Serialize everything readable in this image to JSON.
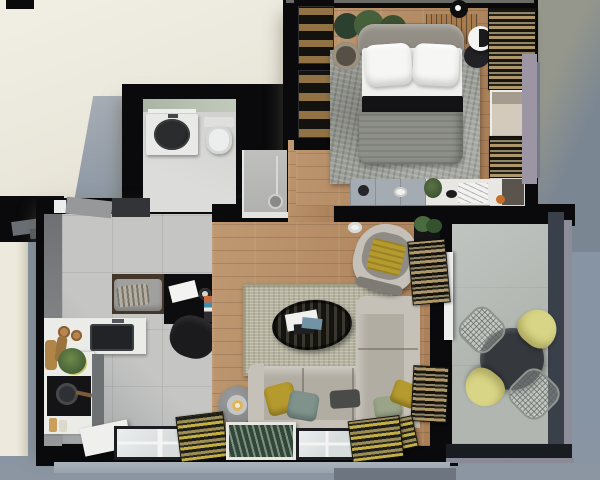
{
  "scene": {
    "title": "Apartment floor plan - top-down 3D render",
    "view": "top-down axonometric",
    "style": "photorealistic architectural visualization, no text labels",
    "rooms": [
      {
        "name": "Bedroom",
        "position": "top right",
        "floor": "wood planks",
        "furniture": [
          "double bed with two white pillows, white sheet and gray duvet",
          "gray upholstered headboard",
          "textured gray area rug",
          "round bedside table with white sphere lamp",
          "black wardrobe with glass display doors",
          "potted plant behind headboard",
          "wood slat bench",
          "sideboard with plant, cup and decor",
          "window with tan striped roman blinds"
        ]
      },
      {
        "name": "Bathroom",
        "position": "top left",
        "floor": "light gray tile",
        "furniture": [
          "white vanity with black oval vessel sink",
          "wall mirror",
          "toilet",
          "walk-in shower with glass panel and chrome column"
        ]
      },
      {
        "name": "Kitchen and entry",
        "position": "middle left",
        "floor": "gray ceramic tile",
        "furniture": [
          "white L-shaped countertop",
          "black undermount sink",
          "black hob with pan",
          "cutting boards, bowls and potted plant",
          "entry bench with gray cushion and striped pillow",
          "black console with papers and camera",
          "vinyl records",
          "dark lounge chair",
          "entry door"
        ]
      },
      {
        "name": "Living room",
        "position": "center",
        "floor": "wood planks",
        "furniture": [
          "beige textured area rug",
          "oval dark-wood coffee table with books",
          "L-shaped gray sofa with white back shelf",
          "mustard, teal, sage and charcoal pillows",
          "round armchair with mustard throw",
          "gray candle stool",
          "white cup and saucer on floor",
          "corner plant on black stand",
          "magazine and shutter stacks",
          "leaning framed botanical print",
          "two mullioned windows with yellow striped curtains"
        ]
      },
      {
        "name": "Balcony",
        "position": "right",
        "floor": "concrete pavers",
        "furniture": [
          "round black dining table",
          "two yellow shell chairs",
          "two wire-frame chairs",
          "dark metal and glass railing with mauve outer frame"
        ]
      }
    ],
    "backdrop": {
      "top_left": "warm cream plane with cast building shadow",
      "top_right": "olive gray fading diagonally to blue gray",
      "bottom_and_right": "cool blue gray"
    },
    "palette": {
      "beige": "#eae7db",
      "bg_blue": "#8794a4",
      "bg_bottom": "#8c96a2",
      "wall": "#0a0a0c",
      "wood": "#b5895f",
      "tile": "#c5c6c4",
      "concrete": "#b1b6b1",
      "rug_living": "#b6b4a0",
      "rug_bedroom": "#9b9d96",
      "sofa": "#b2ada3",
      "sofa_light": "#c6c1b8",
      "headboard": "#8b8780",
      "duvet": "#8d8f88",
      "mattress": "#efefed",
      "pillow_white": "#f6f6f4",
      "mustard": "#b59a2e",
      "teal": "#7f938c",
      "sage": "#9aa488",
      "dark_pillow": "#4a4a48",
      "chair_yellow": "#d9d586",
      "table_dark": "#35383d",
      "vanity": "#e9eae8",
      "sink_black": "#212326",
      "counter": "#ebebe8",
      "plant": "#3c5c38",
      "plant_light": "#5d7245",
      "curtain_tan": "#ad9668",
      "curtain_dark": "#221f19",
      "curtain_yellow": "#c3ae45",
      "sill_purple": "#9c95a3",
      "railing": "#3a404a",
      "dresser_gray": "#a4abb2",
      "dresser_white": "#e8e7e3",
      "glass": "#d7dcdd",
      "picture_green": "#31473a"
    }
  }
}
